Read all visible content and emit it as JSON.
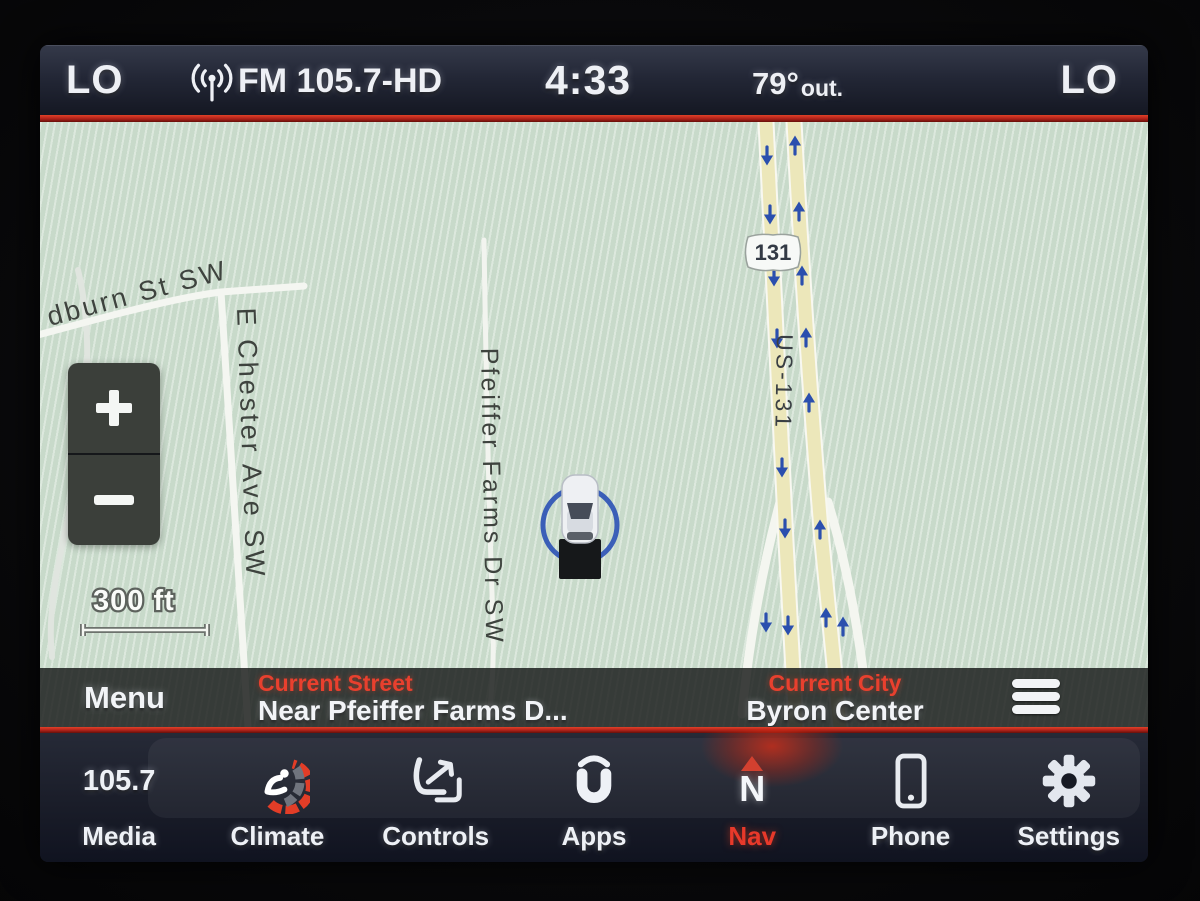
{
  "status_bar": {
    "left_temp_badge": "LO",
    "source_label": "FM 105.7-HD",
    "time": "4:33",
    "outside_temp": "79°",
    "outside_temp_unit": "out.",
    "right_temp_badge": "LO"
  },
  "map": {
    "scale_label": "300 ft",
    "shield_label": "131",
    "street_labels": {
      "woodburn": "dburn St SW",
      "chester": "E Chester Ave SW",
      "pfeiffer": "Pfeiffer Farms Dr SW",
      "highway": "US-131"
    },
    "zoom_controls": {
      "zoom_in_icon": "plus",
      "zoom_out_icon": "minus"
    }
  },
  "overlay_bar": {
    "menu_label": "Menu",
    "current_street_title": "Current Street",
    "current_street_value": "Near Pfeiffer Farms D...",
    "current_city_title": "Current City",
    "current_city_value": "Byron Center",
    "menu_list_icon": "hamburger"
  },
  "app_bar": {
    "items": [
      {
        "id": "media",
        "label": "Media",
        "icon": "station-frequency-text",
        "icon_text": "105.7"
      },
      {
        "id": "climate",
        "label": "Climate",
        "icon": "climate-seat-gauge-icon"
      },
      {
        "id": "controls",
        "label": "Controls",
        "icon": "seat-controls-icon"
      },
      {
        "id": "apps",
        "label": "Apps",
        "icon": "uconnect-apps-icon"
      },
      {
        "id": "nav",
        "label": "Nav",
        "icon": "compass-north-icon",
        "icon_text": "N",
        "active": true
      },
      {
        "id": "phone",
        "label": "Phone",
        "icon": "phone-icon"
      },
      {
        "id": "settings",
        "label": "Settings",
        "icon": "gear-icon"
      }
    ]
  },
  "colors": {
    "accent_red_line": "#b4231b",
    "active_tab_red": "#e8392a",
    "info_title_red": "#e8402e",
    "map_background": "#cedfd0",
    "highway_fill": "#ece7ba",
    "arrow_blue": "#2b4fae",
    "status_bar_bg": "#232736",
    "bezel_black": "#0a0a0c"
  }
}
